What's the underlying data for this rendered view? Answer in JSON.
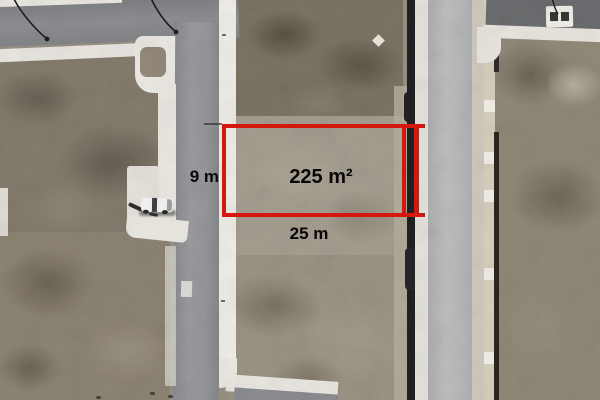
{
  "annotation": {
    "area_label": "225 m²",
    "width_label": "25 m",
    "depth_label": "9 m",
    "outline_color": "#d6170e",
    "label_text_color": "#070707"
  },
  "palette": {
    "terrain_base": "#938b7d",
    "terrain_dark": "#766f5f",
    "road_left": "#8b8d90",
    "road_right": "#b4b5b7",
    "sidewalk": "#e8e5df",
    "fence_line": "#1f1f21",
    "car_body": "#f2f1ee"
  },
  "objects": {
    "vehicle": "white-car",
    "utility_box": "roof-structure-with-two-dark-hatches",
    "power_lines": "thin-black-cables"
  }
}
